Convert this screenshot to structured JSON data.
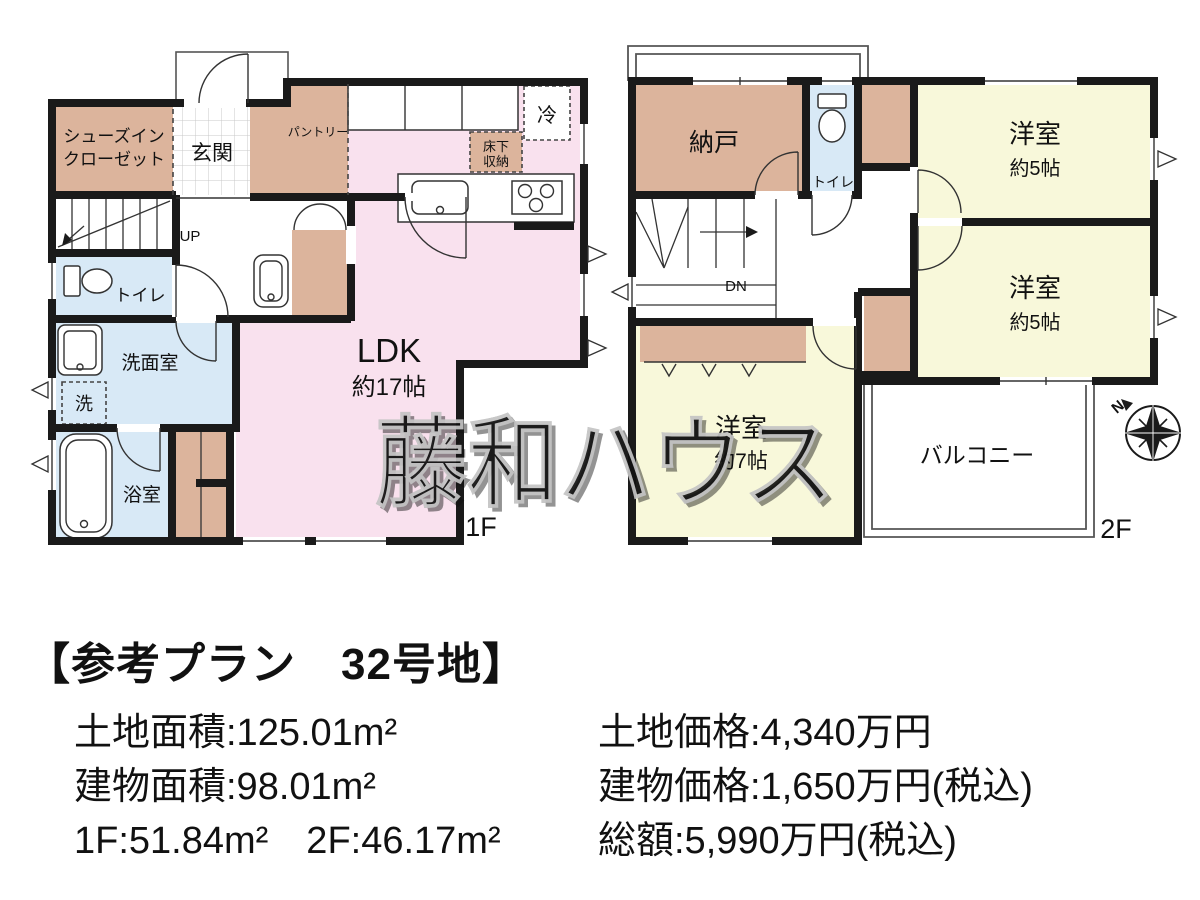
{
  "floor1": {
    "label": "1F",
    "up_label": "UP",
    "rooms": {
      "shoes_line1": "シューズイン",
      "shoes_line2": "クローゼット",
      "genkan": "玄関",
      "pantry": "パントリー",
      "fridge": "冷",
      "underfloor_line1": "床下",
      "underfloor_line2": "収納",
      "toilet": "トイレ",
      "washroom": "洗面室",
      "laundry": "洗",
      "bath": "浴室",
      "ldk": "LDK",
      "ldk_size": "約17帖"
    }
  },
  "floor2": {
    "label": "2F",
    "down_label": "DN",
    "rooms": {
      "storage": "納戸",
      "toilet": "トイレ",
      "bedroom_a": "洋室",
      "bedroom_a_size": "約5帖",
      "bedroom_b": "洋室",
      "bedroom_b_size": "約5帖",
      "bedroom_c": "洋室",
      "bedroom_c_size": "約7帖",
      "balcony": "バルコニー"
    }
  },
  "compass": {
    "north_label": "N"
  },
  "watermark_text": "藤和ハウス",
  "info": {
    "title": "【参考プラン　32号地】",
    "land_area": "土地面積:125.01m²",
    "building_area": "建物面積:98.01m²",
    "floor_areas": "1F:51.84m²　2F:46.17m²",
    "land_price": "土地価格:4,340万円",
    "building_price": "建物価格:1,650万円(税込)",
    "total_price": "総額:5,990万円(税込)"
  },
  "colors": {
    "wall": "#1a1a1a",
    "ldk": "#f9e1ee",
    "western_room": "#f8f8da",
    "wet_area": "#d8e9f6",
    "closet": "#dcb49c",
    "tile_line": "#c9c9c9"
  }
}
